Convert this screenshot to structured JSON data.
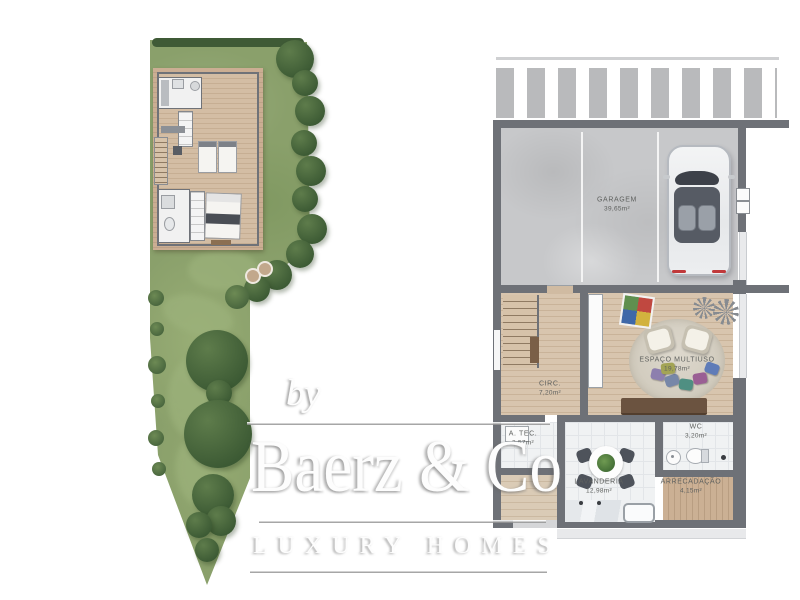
{
  "watermark": {
    "prefix": "by",
    "brand": "Baerz & Co",
    "tagline": "LUXURY HOMES"
  },
  "rooms": {
    "garagem": {
      "name": "GARAGEM",
      "area": "39,65m²"
    },
    "circ": {
      "name": "CIRC.",
      "area": "7,20m²"
    },
    "espaco_multiuso": {
      "name": "ESPAÇO MULTIUSO",
      "area": "19,78m²"
    },
    "a_tec": {
      "name": "A. TEC.",
      "area": "2,57m²"
    },
    "lavanderia": {
      "name": "LAVANDERIA",
      "area": "12,98m²"
    },
    "wc": {
      "name": "WC",
      "area": "3,20m²"
    },
    "arrecadacao": {
      "name": "ARRECADAÇÃO",
      "area": "4,15m²"
    }
  },
  "palette": {
    "wall": "#6e7177",
    "garage_floor": "#c7c8ca",
    "wood_floor": "#d7c4ad",
    "deck": "#c9ad92",
    "grass": "#8aa06b",
    "tree": "#42603a",
    "tile": "#f0f2f3",
    "watermark": "#ffffff"
  }
}
